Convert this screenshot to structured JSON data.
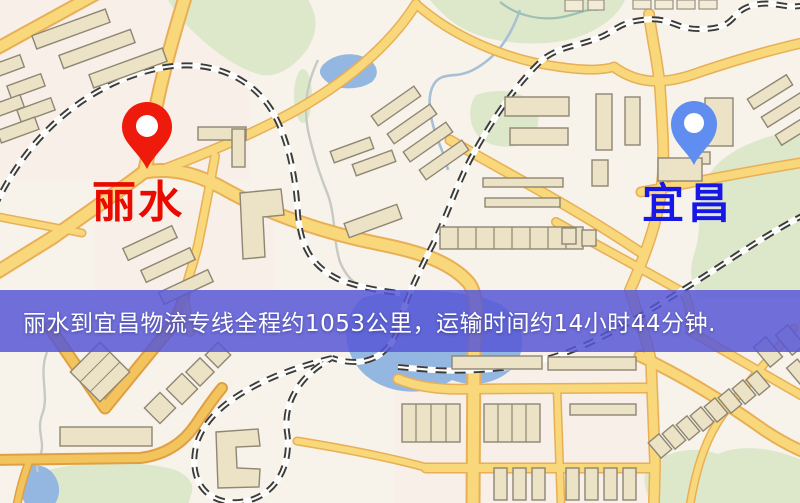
{
  "map": {
    "markers": [
      {
        "id": "origin",
        "label": "丽水",
        "pin_color": "#ee1b0d",
        "label_color": "#e90a00"
      },
      {
        "id": "destination",
        "label": "宜昌",
        "pin_color": "#5f8ef0",
        "label_color": "#1818e6"
      }
    ]
  },
  "banner": {
    "text": "丽水到宜昌物流专线全程约1053公里，运输时间约14小时44分钟.",
    "background": "#5656d7",
    "text_color": "#ffffff"
  },
  "route": {
    "origin": "丽水",
    "destination": "宜昌",
    "distance_text": "约1053公里",
    "duration_text": "约14小时44分钟"
  }
}
